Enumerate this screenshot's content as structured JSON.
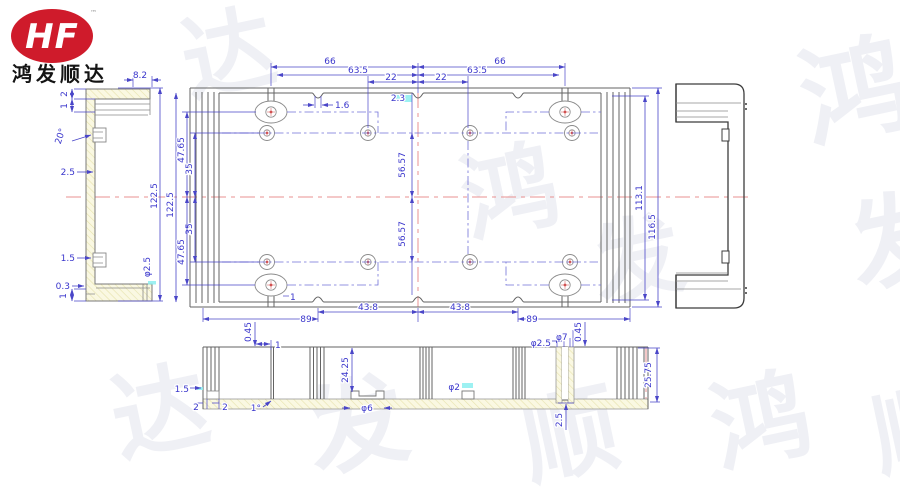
{
  "logo": {
    "initials": "HF",
    "trademark": "™",
    "company": "鸿发顺达"
  },
  "colors": {
    "dimension_blue": "#3a36cc",
    "centerline_red": "#e89090",
    "hatch_yellow": "#faf8e2",
    "logo_red": "#cf1b2b",
    "highlight_cyan": "#8ceef0"
  },
  "watermark": {
    "chars": [
      "达",
      "鸿",
      "鸿",
      "发",
      "发",
      "达",
      "发",
      "顺",
      "鸿",
      "顺"
    ]
  },
  "dims": {
    "top": {
      "d66_l": "66",
      "d635_l": "63.5",
      "d22_l": "22",
      "d22_r": "22",
      "d635_r": "63.5",
      "d66_r": "66",
      "notch": "1.6",
      "center_gap": "2.3"
    },
    "left_chain": {
      "total_a": "122.5",
      "total_b": "122.5",
      "t4765_t": "47.65",
      "t35_t": "35",
      "t35_b": "35",
      "t4765_b": "47.65"
    },
    "center": {
      "v_t": "56.57",
      "v_b": "56.57"
    },
    "right_chain": {
      "inner": "113.1",
      "outer": "116.5"
    },
    "bottom_chain": {
      "d89_l": "89",
      "d438_l": "43.8",
      "d438_r": "43.8",
      "d89_r": "89",
      "slot": "1"
    },
    "side_view": {
      "w": "8.2",
      "t2": "2",
      "t1": "1",
      "ang": "20°",
      "w25": "2.5",
      "c15": "1.5",
      "c03": "0.3",
      "c1": "1",
      "h": "122.5",
      "hole": "φ2.5"
    },
    "section": {
      "s045_l": "0.45",
      "s1": "1",
      "s2425": "24.25",
      "s15": "1.5",
      "s2a": "2",
      "s2b": "2",
      "taper": "1°",
      "dia6": "φ6",
      "dia2": "φ2",
      "dia25": "φ2.5",
      "dia7": "φ7",
      "s045_r": "0.45",
      "s2575": "25.75",
      "s25": "2.5"
    }
  }
}
